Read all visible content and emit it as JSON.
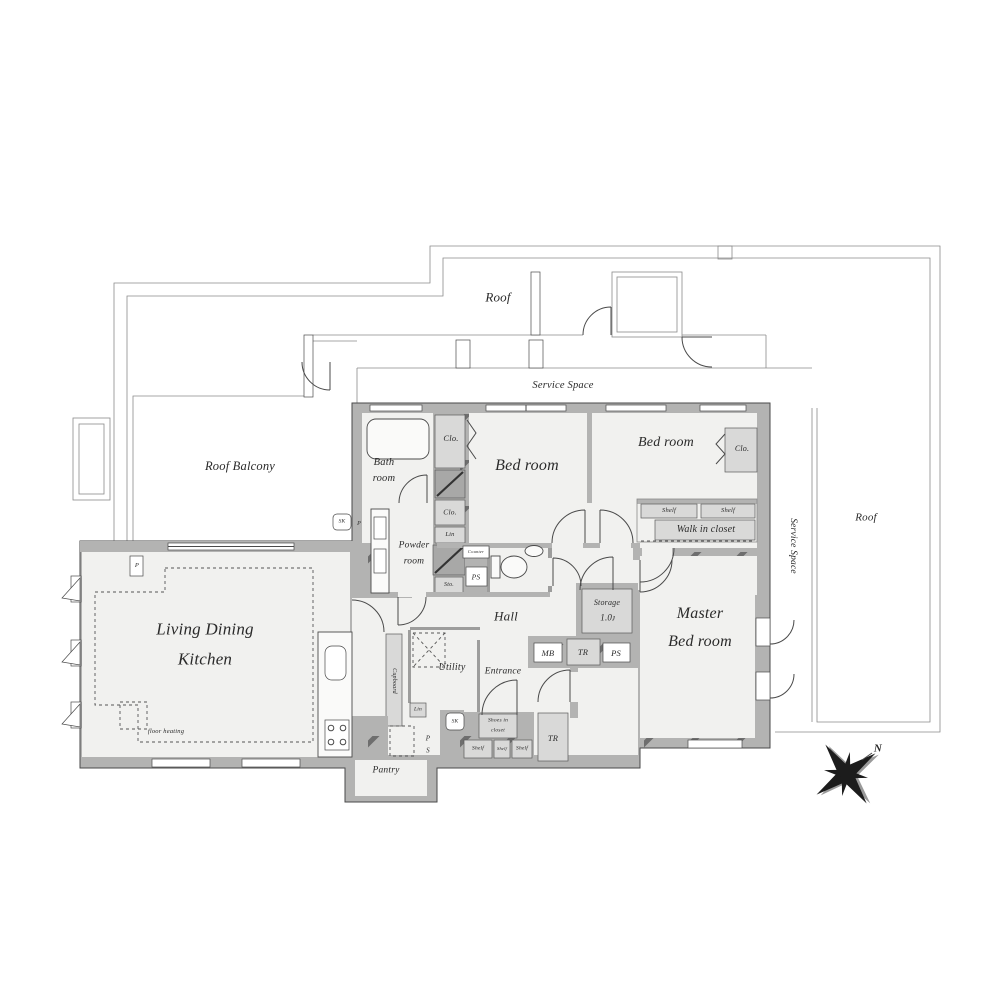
{
  "title": "apartment-floor-plan",
  "colors": {
    "wall": "#b3b3b2",
    "floor": "#f1f1ef",
    "closet": "#d9d9d8",
    "line": "#4a4a4a"
  },
  "labels": {
    "roof_top": "Roof",
    "roof_right": "Roof",
    "roof_balcony": "Roof Balcony",
    "service_space_top": "Service Space",
    "service_space_right": "Service Space",
    "bath_line1": "Bath",
    "bath_line2": "room",
    "clo_1": "Clo.",
    "clo_2": "Clo.",
    "clo_3": "Clo.",
    "bed_room_1": "Bed room",
    "bed_room_2": "Bed room",
    "shelf_1": "Shelf",
    "shelf_2": "Shelf",
    "shelf_3": "Shelf",
    "shelf_4": "Shelf",
    "shelf_5": "Shelf",
    "walk_in_closet": "Walk in closet",
    "powder_line1": "Powder",
    "powder_line2": "room",
    "lin_1": "Lin",
    "lin_2": "Lin",
    "counter": "Counter",
    "ps_1": "PS",
    "ps_2": "PS",
    "ps_v_p": "P",
    "ps_v_s": "S",
    "sto": "Sto.",
    "hall": "Hall",
    "storage_line1": "Storage",
    "storage_line2": "1.0ᴊ",
    "mb": "MB",
    "tr_1": "TR",
    "tr_2": "TR",
    "master_line1": "Master",
    "master_line2": "Bed room",
    "ldk_line1": "Living Dining",
    "ldk_line2": "Kitchen",
    "floor_heating": "floor heating",
    "p_1": "P",
    "p_2": "P",
    "sk_1": "SK",
    "sk_2": "SK",
    "utility": "Utility",
    "entrance": "Entrance",
    "cupboard": "Cupboard",
    "shoes_line1": "Shoes in",
    "shoes_line2": "closet",
    "pantry": "Pantry",
    "north": "N"
  }
}
